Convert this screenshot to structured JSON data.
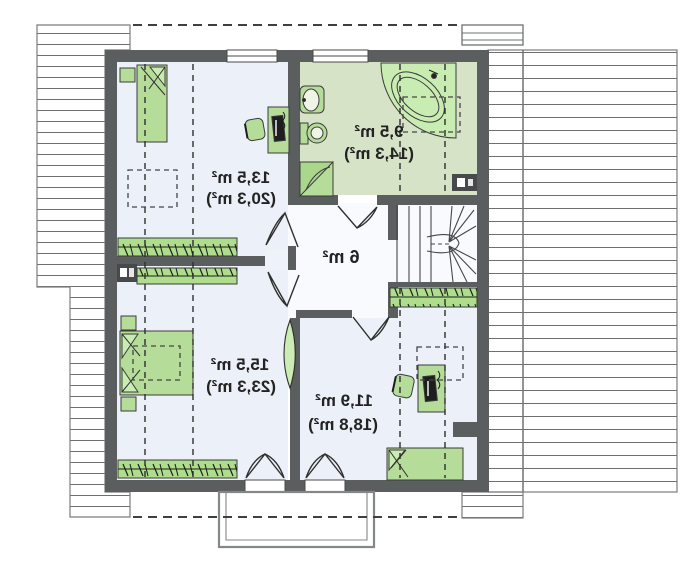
{
  "meta": {
    "type": "architectural-floor-plan",
    "view": "attic storey, mirrored (lustrzane) plan — all labels render mirror-reversed",
    "canvas": {
      "width": 700,
      "height": 575
    }
  },
  "palette": {
    "wall": "#5b5e5e",
    "wall_dark": "#474a4a",
    "room_floor": "#ecf1f9",
    "hall_floor": "#f8fafd",
    "bath_floor": "#d7e3c7",
    "furniture": "#b5dc99",
    "furniture_bright": "#c9ecb2",
    "furniture_shade": "#a9d78c",
    "hatch_line": "#6f6f6f",
    "outline": "#3b3b3b",
    "dash": "#2e2e2e",
    "balcony": "#848787",
    "text": "#232323"
  },
  "rooms": [
    {
      "id": "room-top-left",
      "area": "13,5 m²",
      "area_total": "(20,3 m²)"
    },
    {
      "id": "bathroom",
      "area": "9,5 m²",
      "area_total": "(14,3 m²)"
    },
    {
      "id": "hall",
      "area": "6 m²",
      "area_total": ""
    },
    {
      "id": "room-bottom-left",
      "area": "15,5 m²",
      "area_total": "(23,3 m²)"
    },
    {
      "id": "room-bottom-right",
      "area": "11,9 m²",
      "area_total": "(18,8 m²)"
    }
  ]
}
